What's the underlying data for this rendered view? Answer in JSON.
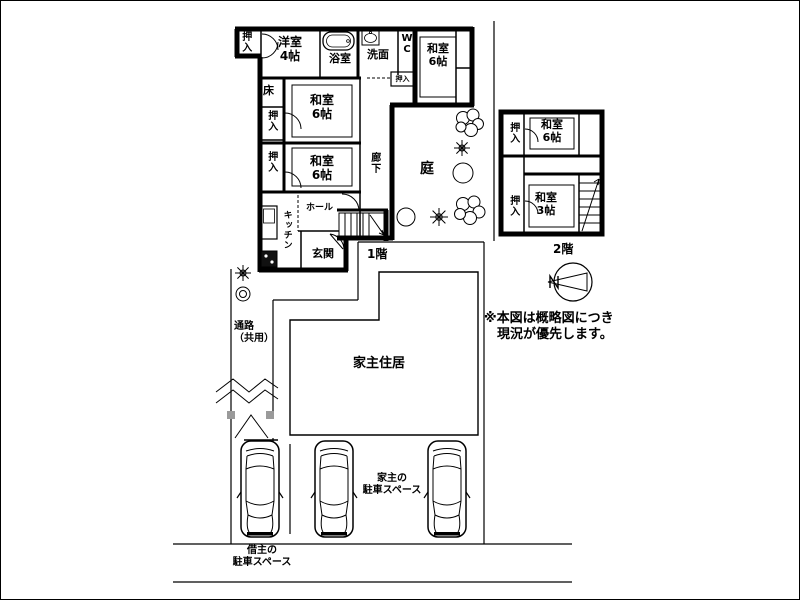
{
  "palette": {
    "ink": "#000000",
    "paper": "#ffffff",
    "gate_post": "#9a9a9a"
  },
  "floor1": {
    "floor_label": "1階",
    "rooms": {
      "closet_tl": "押入",
      "western_room": "洋室\n4帖",
      "bathroom": "浴室",
      "washroom": "洗面",
      "wc": "W\nC",
      "tatami_ne": "和室\n6帖",
      "closet_mini": "押入",
      "alcove": "床",
      "tatami_mid1": "和室\n6帖",
      "closet_mid1": "押入",
      "closet_mid2": "押入",
      "tatami_mid2": "和室\n6帖",
      "corridor": "廊下",
      "garden": "庭",
      "kitchen": "キッチン",
      "hall": "ホール",
      "entrance": "玄関"
    }
  },
  "floor2": {
    "floor_label": "2階",
    "rooms": {
      "closet_upper": "押入",
      "tatami_6": "和室\n6帖",
      "closet_lower": "押入",
      "tatami_3": "和室\n3帖"
    }
  },
  "site": {
    "passage_label": "通路\n（共用）",
    "owner_residence_label": "家主住居",
    "owner_parking_label": "家主の\n駐車スペース",
    "tenant_parking_label": "借主の\n駐車スペース",
    "note": "※本図は概略図につき\n　現況が優先します。"
  }
}
